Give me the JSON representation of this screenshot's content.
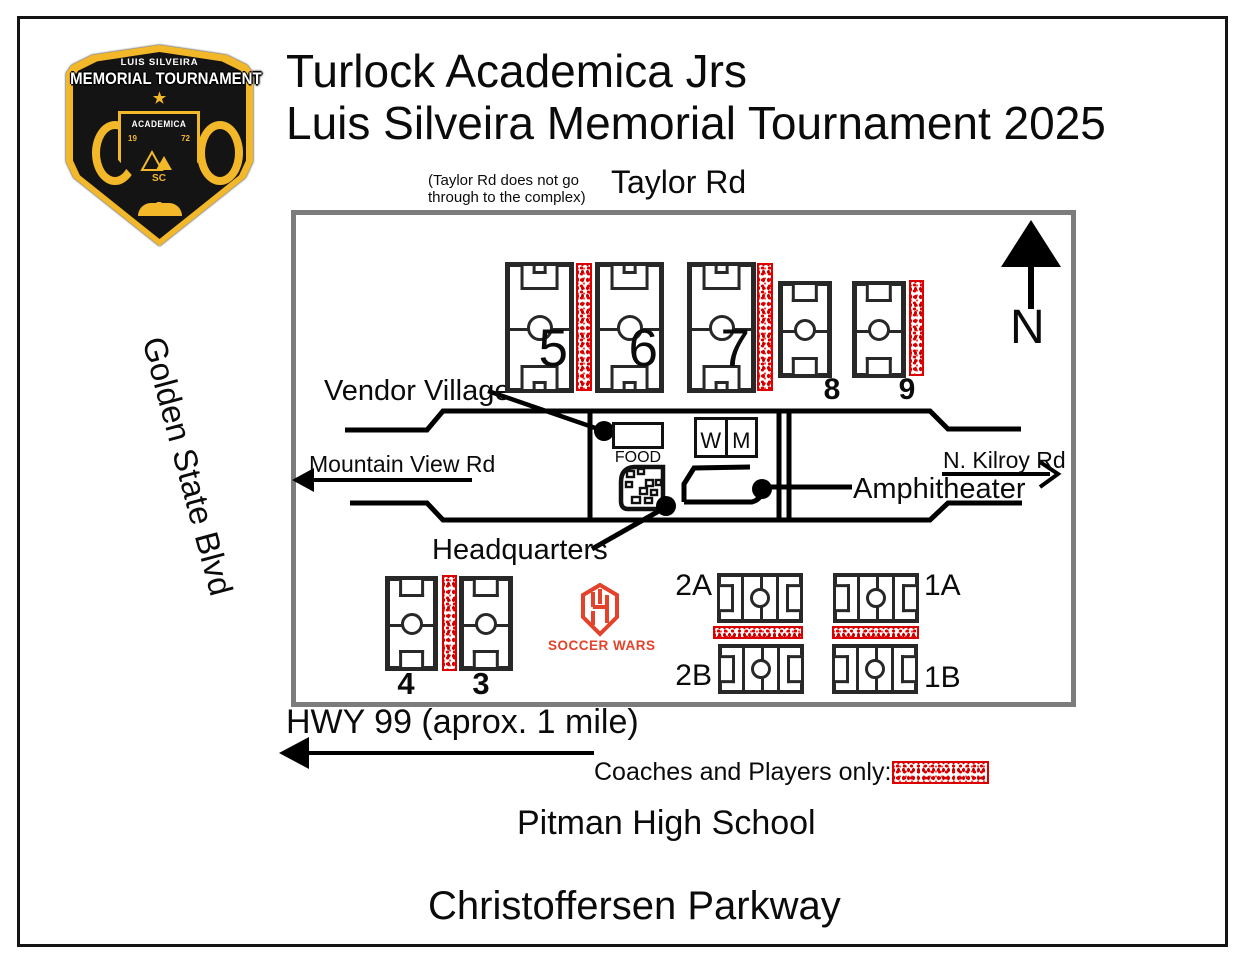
{
  "header": {
    "title_line1": "Turlock Academica Jrs",
    "title_line2": "Luis Silveira Memorial Tournament 2025"
  },
  "badge": {
    "subtitle": "LUIS SILVEIRA",
    "title": "MEMORIAL TOURNAMENT",
    "star": "★",
    "crest_title": "ACADEMICA",
    "year_left": "19",
    "year_right": "72",
    "crest_initials": "SC"
  },
  "streets": {
    "taylor": "Taylor Rd",
    "taylor_note_line1": "(Taylor Rd does not go",
    "taylor_note_line2": "through to the complex)",
    "golden_state": "Golden State Blvd",
    "mountain_view": "Mountain View Rd",
    "n_kilroy": "N. Kilroy Rd",
    "hwy99": "HWY 99 (aprox. 1 mile)",
    "pitman": "Pitman High School",
    "christoffersen": "Christoffersen Parkway"
  },
  "map": {
    "compass": "N",
    "vendor_village": "Vendor Village",
    "food": "FOOD",
    "restroom_w": "W",
    "restroom_m": "M",
    "amphitheater": "Amphitheater",
    "headquarters": "Headquarters",
    "legend_label": "Coaches and Players only:",
    "fields": {
      "f5": "5",
      "f6": "6",
      "f7": "7",
      "f8": "8",
      "f9": "9",
      "f4": "4",
      "f3": "3",
      "f2a": "2A",
      "f1a": "1A",
      "f2b": "2B",
      "f1b": "1B"
    }
  },
  "branding": {
    "soccer_wars": "SOCCER WARS"
  },
  "colors": {
    "legend_red": "#DD0000",
    "map_border_gray": "#7C7C7C",
    "field_line": "#282828",
    "badge_gold": "#F3B82A",
    "soccer_wars_red": "#E2432A"
  }
}
